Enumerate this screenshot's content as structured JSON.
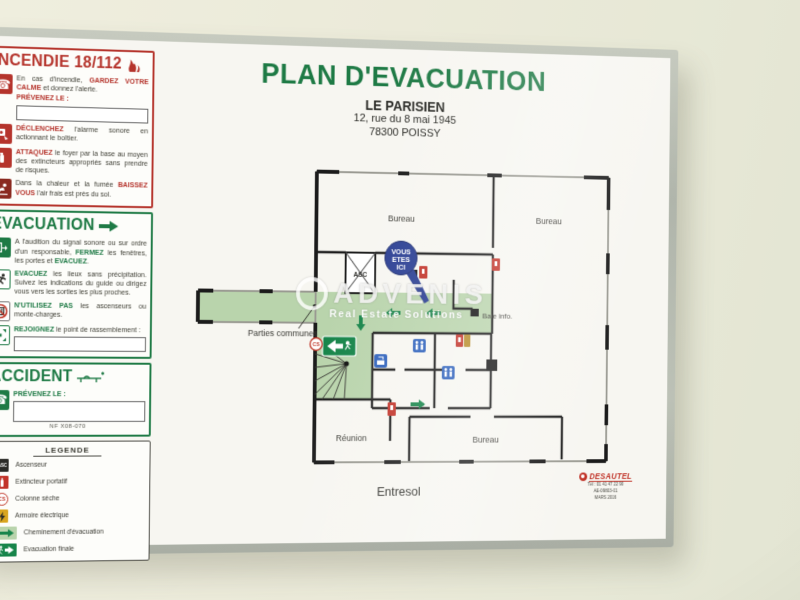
{
  "colors": {
    "accent_green": "#1e7a45",
    "accent_red": "#b5342c",
    "corridor_green": "#b9d4ac",
    "marker_blue": "#2b3f93",
    "wc_blue": "#2f62bc",
    "legend_yellow": "#d9a520",
    "frame_grey": "#b8bdb3",
    "board_bg": "#f7f6f1",
    "exit_sign_green": "#17854a"
  },
  "icons": {
    "phone": "☎",
    "phone_plus": "☎",
    "flame": "flame-shape",
    "title_arrow": "thick-right-arrow",
    "stretcher": "stretcher-shape"
  },
  "head": {
    "title": "PLAN D'EVACUATION",
    "building": "LE PARISIEN",
    "address1": "12, rue du 8 mai 1945",
    "address2": "78300 POISSY"
  },
  "floor_label": "Entresol",
  "incendie": {
    "title": "INCENDIE 18/112",
    "prevenez": "PRÉVENEZ LE :",
    "items": [
      {
        "s0": "En cas d'incendie, ",
        "b0": "GARDEZ VOTRE CALME",
        "s1": " et donnez l'alerte."
      },
      {
        "b0": "DÉCLENCHEZ",
        "s0": " l'alarme sonore en actionnant le boîtier."
      },
      {
        "b0": "ATTAQUEZ",
        "s0": " le foyer par la base au moyen des extincteurs appropriés sans prendre de risques."
      },
      {
        "s0": "Dans la chaleur et la fumée ",
        "b0": "BAISSEZ VOUS",
        "s1": " l'air frais est près du sol."
      }
    ]
  },
  "evacuation": {
    "title": "EVACUATION",
    "items": [
      {
        "s0": "A l'audition du signal sonore ou sur ordre d'un responsable, ",
        "b0": "FERMEZ",
        "s1": " les fenêtres, les portes et ",
        "b1": "EVACUEZ",
        "s2": "."
      },
      {
        "b0": "EVACUEZ",
        "s0": " les lieux sans précipitation. Suivez les indications du guide ou dirigez vous vers les sorties les plus proches."
      },
      {
        "b0": "N'UTILISEZ PAS",
        "s0": " les ascenseurs ou monte-charges."
      },
      {
        "b0": "REJOIGNEZ",
        "s0": " le point de rassemblement :"
      }
    ]
  },
  "accident": {
    "title": "ACCIDENT",
    "prevenez": "PRÉVENEZ LE :",
    "norm": "NF X08-070"
  },
  "legende": {
    "title": "LEGENDE",
    "asc_text": "ASC",
    "cs_text": "CS",
    "items": [
      "Ascenseur",
      "Extincteur portatif",
      "Colonne sèche",
      "Armoire électrique",
      "Cheminement d'évacuation",
      "Evacuation finale"
    ]
  },
  "plan": {
    "rooms": {
      "bureau_top_left": "Bureau",
      "bureau_top_right": "Bureau",
      "bureau_bottom": "Bureau",
      "reunion": "Réunion",
      "baie_info": "Baie info.",
      "parties_communes": "Parties communes",
      "asc": "ASC"
    },
    "marker": {
      "l1": "VOUS",
      "l2": "ETES",
      "l3": "ICI"
    },
    "cs": "CS"
  },
  "watermark": {
    "name": "ADVENIS",
    "tagline": "Real Estate Solutions"
  },
  "vendor": {
    "name": "DESAUTEL",
    "line1": "Tél : 01 41 47 22 90",
    "line2": "AE-09803-01",
    "line3": "MARS 2016"
  }
}
